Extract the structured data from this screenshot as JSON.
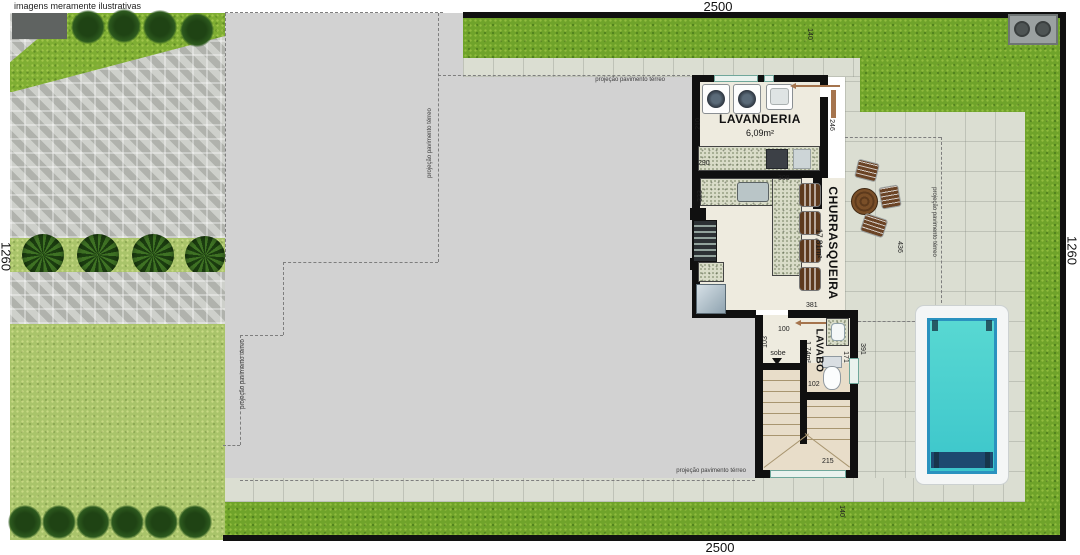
{
  "disclaimer": "imagens meramente ilustrativas",
  "lot": {
    "top": "2500",
    "bottom": "2500",
    "left": "1260",
    "right": "1260"
  },
  "setbacks": {
    "top": "140",
    "bottom": "140"
  },
  "rooms": {
    "lavanderia": {
      "name": "LAVANDERIA",
      "area": "6,09m²"
    },
    "churrasqueira": {
      "name": "CHURRASQUEIRA",
      "area": "17,81m²"
    },
    "lavabo": {
      "name": "LAVABO",
      "area": "1,74m²"
    }
  },
  "labels": {
    "projection": "projeção pavimento térreo",
    "stairs_up": "sobe"
  },
  "dims": {
    "d210": "210",
    "d290": "290",
    "d246": "246",
    "d323": "323",
    "d308": "308",
    "d381": "381",
    "d436": "436",
    "d100": "100",
    "d103": "103",
    "d171": "171",
    "d102": "102",
    "d391": "391",
    "d215": "215"
  },
  "colors": {
    "grass": "#6fa32a",
    "grass_light": "#a9c46a",
    "slab": "#d2d2d2",
    "patio": "#dbded2",
    "wall": "#101010",
    "pool_water": "#45cdcc",
    "granite": "#d9dcc8",
    "door": "#a5744d"
  }
}
